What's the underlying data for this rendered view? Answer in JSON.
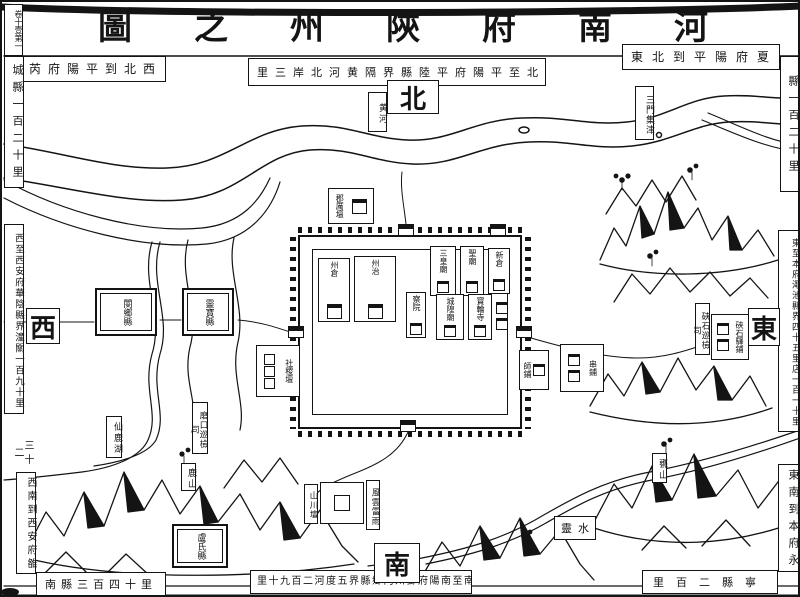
{
  "title": "圖之州陝府南河",
  "page_marker": "卷十壹第一",
  "compass": {
    "north": "北",
    "south": "南",
    "east": "東",
    "west": "西"
  },
  "strips": {
    "top_left": "芮府陽平到北西",
    "left_top": "城縣一百二十里",
    "top_mid": "里三岸北河黄隔界縣陸平府陽平至北",
    "top_right": "東北到平陽府夏",
    "right_top": "縣一百二十里",
    "right_mid": "東至本府澠池縣界四十五里店一百一十里",
    "right_bottom": "東南到本府永",
    "bottom_right": "里百二縣寧",
    "bottom_mid": "里十九百二河度五界縣鄉内州鄧府陽南至南",
    "bottom_left": "南縣三百四十里",
    "left_bottom": "西南到西安府雒",
    "left_small": "三十二",
    "left_mid": "西至西安府華陰縣界潼關一百九十里"
  },
  "water": {
    "yellow_river": "黄河",
    "sanmen_ford": "三門集津",
    "ling_shui": "靈水",
    "xianlu_lake": "仙鹿湖"
  },
  "mountains": {
    "lu_shan": "鹿山",
    "weng_shan": "甕山"
  },
  "towns": {
    "wenxiang": "閿鄉縣",
    "lingbao": "靈寶縣",
    "lushi": "盧氏縣"
  },
  "city": {
    "granary": "州倉",
    "yamen": "州治",
    "sanhuang_temple": "三皇廟",
    "sage_temple": "聖廟",
    "new_granary": "新倉",
    "censorate": "察院",
    "chenghuang_temple": "城隍廟",
    "baolun_temple": "寶輪寺"
  },
  "altars": {
    "jun_li_altar": "郡厲壇",
    "sheji_altar": "社稷壇",
    "shanchuan_altar": "山川壇",
    "fengyun_leiyu": "風雲雷雨"
  },
  "posts": {
    "shi_post": "師鋪",
    "chuan_post": "串鋪",
    "xiashi_patrol": "硤石巡檢司",
    "xiashi_station": "硤石驛鋪",
    "mokou_patrol": "磨口巡檢司"
  }
}
